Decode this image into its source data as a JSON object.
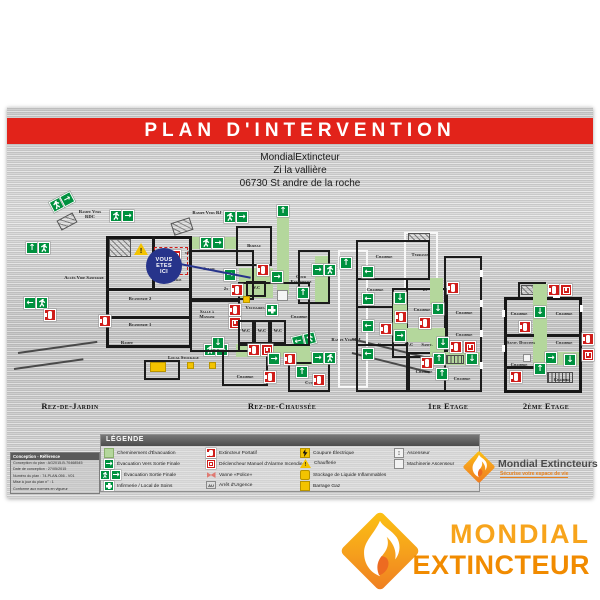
{
  "banner": {
    "title": "PLAN D'INTERVENTION"
  },
  "address": {
    "line1": "MondialExtincteur",
    "line2": "Zi la vallière",
    "line3": "06730 St andre de la roche"
  },
  "marker": {
    "l1": "VOUS",
    "l2": "ETES",
    "l3": "ICI"
  },
  "floors": [
    {
      "name": "Rez-de-Jardin",
      "labels": {
        "rampe_vers_rdc": "Rampe Vers RDC",
        "acces_vide_sanitaire": "Accès Vide Sanitaire",
        "chaufferie": "Chaufferie",
        "vide_sanitaire": "Vide Sanitaire",
        "buanderie2": "Buanderie 2",
        "buanderie1": "Buanderie 1",
        "rampe": "Rampe",
        "local_stockage": "Local Stockage",
        "rampe_vers_rj": "Rampe Vers RJ",
        "x2": "x2"
      }
    },
    {
      "name": "Rez-de-Chaussée",
      "labels": {
        "rampe_vers_rj": "Rampe Vers RJ",
        "bureau": "Bureau",
        "salon": "Salon",
        "wc1": "W.C",
        "wc2": "W.C",
        "wc3": "W.C",
        "wc4": "W.C",
        "cour_exterieure": "Cour Extérieure",
        "vestiaires": "Vestiaires",
        "salle_a_manger": "Salle à Manger",
        "chambre1": "Chambre",
        "chambre2": "Chambre",
        "cuisine": "Cuisine",
        "x2": "2x"
      }
    },
    {
      "name": "1er Etage",
      "labels": {
        "chambre1": "Chambre",
        "terrasse": "Terrasse",
        "chambre2": "Chambre",
        "chambre3": "Chambre",
        "chambre4": "Chambre",
        "chambre5": "Chambre",
        "chambre6": "Chambre",
        "chambre7": "Chambre",
        "chambre8": "Chambre",
        "wc": "W.C",
        "sanit": "Sanit.",
        "x2": "2x"
      }
    },
    {
      "name": "2ème Etage",
      "labels": {
        "chambre1": "Chambre",
        "chambre2": "Chambre",
        "sanit_douches": "Sanit. Douches",
        "chambre3": "Chambre",
        "chambre4": "Chambre",
        "chambre5": "Chambre"
      }
    }
  ],
  "legend": {
    "title": "LÉGENDE",
    "au": "AU",
    "col1": [
      {
        "icon": "evacuation-path",
        "label": "Cheminement d'Évacuation"
      },
      {
        "icon": "arrow-exit",
        "label": "Évacuation Vers Sortie Finale"
      },
      {
        "icon": "exit-sign",
        "label": "Évacuation Sortie Finale"
      },
      {
        "icon": "first-aid",
        "label": "Infirmerie / Local de Soins"
      }
    ],
    "col2": [
      {
        "icon": "extinguisher",
        "label": "Extincteur Portatif"
      },
      {
        "icon": "manual-alarm",
        "label": "Déclencheur Manuel d'Alarme Incendie"
      },
      {
        "icon": "valve",
        "label": "Vanne «Police»"
      },
      {
        "icon": "emergency-stop",
        "label": "Arrêt d'Urgence"
      }
    ],
    "col3": [
      {
        "icon": "power-cut",
        "label": "Coupure Électrique"
      },
      {
        "icon": "boiler-warning",
        "label": "Chaufferie"
      },
      {
        "icon": "flammable-storage",
        "label": "Stockage de Liquide Inflammables"
      },
      {
        "icon": "gas-shutoff",
        "label": "Barrage Gaz"
      }
    ],
    "col4": [
      {
        "icon": "elevator",
        "label": "Ascenseur"
      },
      {
        "icon": "elevator-machinery",
        "label": "Machinerie Ascenseur"
      }
    ]
  },
  "info_box": {
    "header": "Conception - Référence",
    "lines": [
      "Conception du plan : AG2015-B-70468545",
      "Date de conception : 27/05/2015",
      "Numéro du plan : 74-PLAN-056 - V01",
      "Mise à jour du plan n° : 1",
      "Conforme aux normes en vigueur"
    ]
  },
  "plate_logo": {
    "name": "Mondial Extincteurs",
    "tagline": "Sécurise votre espace de vie"
  },
  "brand": {
    "word1": "MONDIAL",
    "word2": "EXTINCTEUR"
  },
  "colors": {
    "banner_red": "#E2231A",
    "evac_green": "#00913F",
    "path_green": "#B4D79C",
    "alarm_red": "#CF1D1A",
    "marker_blue": "#27348B",
    "safety_yellow": "#F3C300",
    "brand_orange_light": "#F7A41C",
    "brand_orange_dark": "#F18B00"
  }
}
